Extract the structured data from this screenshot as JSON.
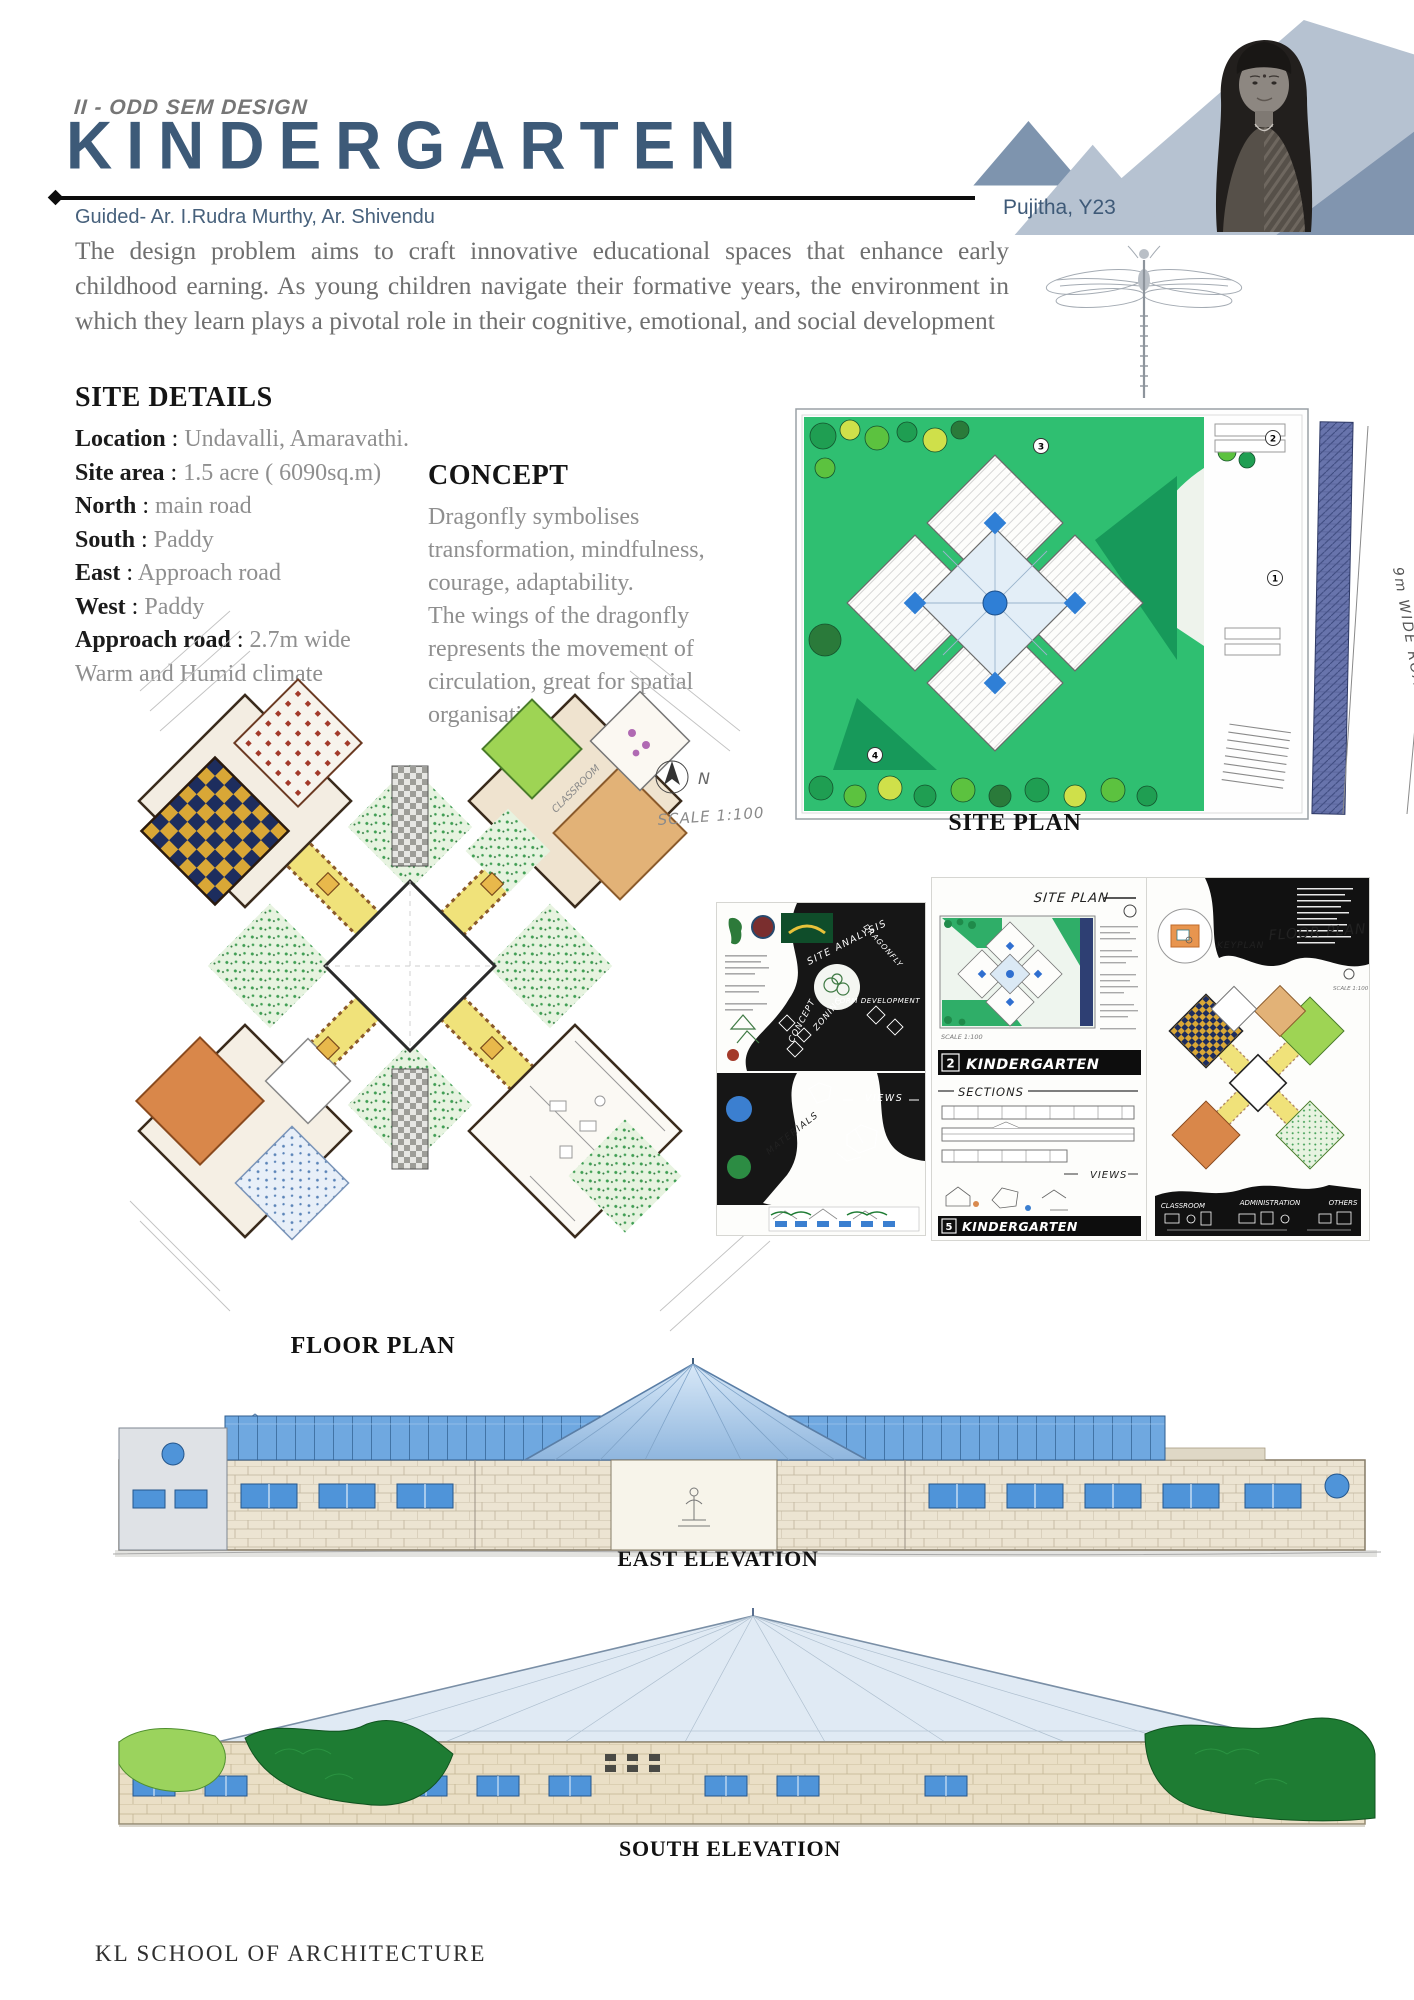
{
  "header": {
    "eyebrow": "II - ODD SEM DESIGN",
    "title": "KINDERGARTEN",
    "guided": "Guided- Ar. I.Rudra Murthy, Ar. Shivendu",
    "author": "Pujitha, Y23"
  },
  "intro": {
    "text": "The design problem aims to craft innovative educational spaces that enhance early childhood earning. As young children navigate their formative years, the environment in which they learn plays a pivotal role in their cognitive, emotional, and social development"
  },
  "site_details": {
    "heading": "SITE DETAILS",
    "rows": [
      {
        "label": "Location",
        "value": "Undavalli, Amaravathi."
      },
      {
        "label": "Site area",
        "value": "1.5 acre ( 6090sq.m)"
      },
      {
        "label": "North",
        "value": "main road"
      },
      {
        "label": "South",
        "value": "Paddy"
      },
      {
        "label": "East",
        "value": "Approach road"
      },
      {
        "label": "West",
        "value": "Paddy"
      },
      {
        "label": "Approach road",
        "value": "2.7m wide"
      }
    ],
    "climate": "Warm and Humid climate"
  },
  "concept": {
    "heading": "CONCEPT",
    "body": "Dragonfly symbolises transformation, mindfulness, courage, adaptability.\nThe wings of the dragonfly represents the movement of circulation, great for spatial organisation."
  },
  "site_plan": {
    "caption": "SITE PLAN",
    "road_label": "9m WIDE ROAD",
    "markers": [
      "1",
      "2",
      "3",
      "4"
    ]
  },
  "floor_plan": {
    "caption": "FLOOR PLAN",
    "scale_label": "SCALE 1:100",
    "compass_label": "N",
    "room_label": "CLASSROOM"
  },
  "boards": {
    "board1": {
      "site_analysis": "SITE ANALYSIS",
      "concept": "CONCEPT",
      "zoning": "ZONING",
      "dragonfly": "DRAGONFLY",
      "form_development": "FORM DEVELOPMENT",
      "views": "VIEWS",
      "materials": "MATERIALS"
    },
    "board2": {
      "title": "SITE PLAN",
      "sheet_no_top": "2",
      "logo_top": "KINDERGARTEN",
      "scale_label": "SCALE 1:100",
      "sections": "SECTIONS",
      "views": "VIEWS",
      "sheet_no_bottom": "5",
      "logo_bottom": "KINDERGARTEN"
    },
    "board3": {
      "keyplan": "KEYPLAN",
      "floorplan": "FLOOR PLAN",
      "scale_label": "SCALE 1:100",
      "legend": [
        "CLASSROOM",
        "ADMINISTRATION",
        "OTHERS"
      ]
    }
  },
  "elevations": {
    "east_caption": "EAST ELEVATION",
    "south_caption": "SOUTH ELEVATION"
  },
  "footer": {
    "text": "KL SCHOOL OF ARCHITECTURE"
  },
  "colors": {
    "title_blue": "#3d5a78",
    "text_gray": "#6f6f6f",
    "lawn_green": "#2fbf71",
    "accent_blue": "#2f7fd6",
    "corridor_yellow": "#f0e27a",
    "window_blue": "#4f94d9",
    "stone": "#eadfc6",
    "board_black": "#161616"
  }
}
